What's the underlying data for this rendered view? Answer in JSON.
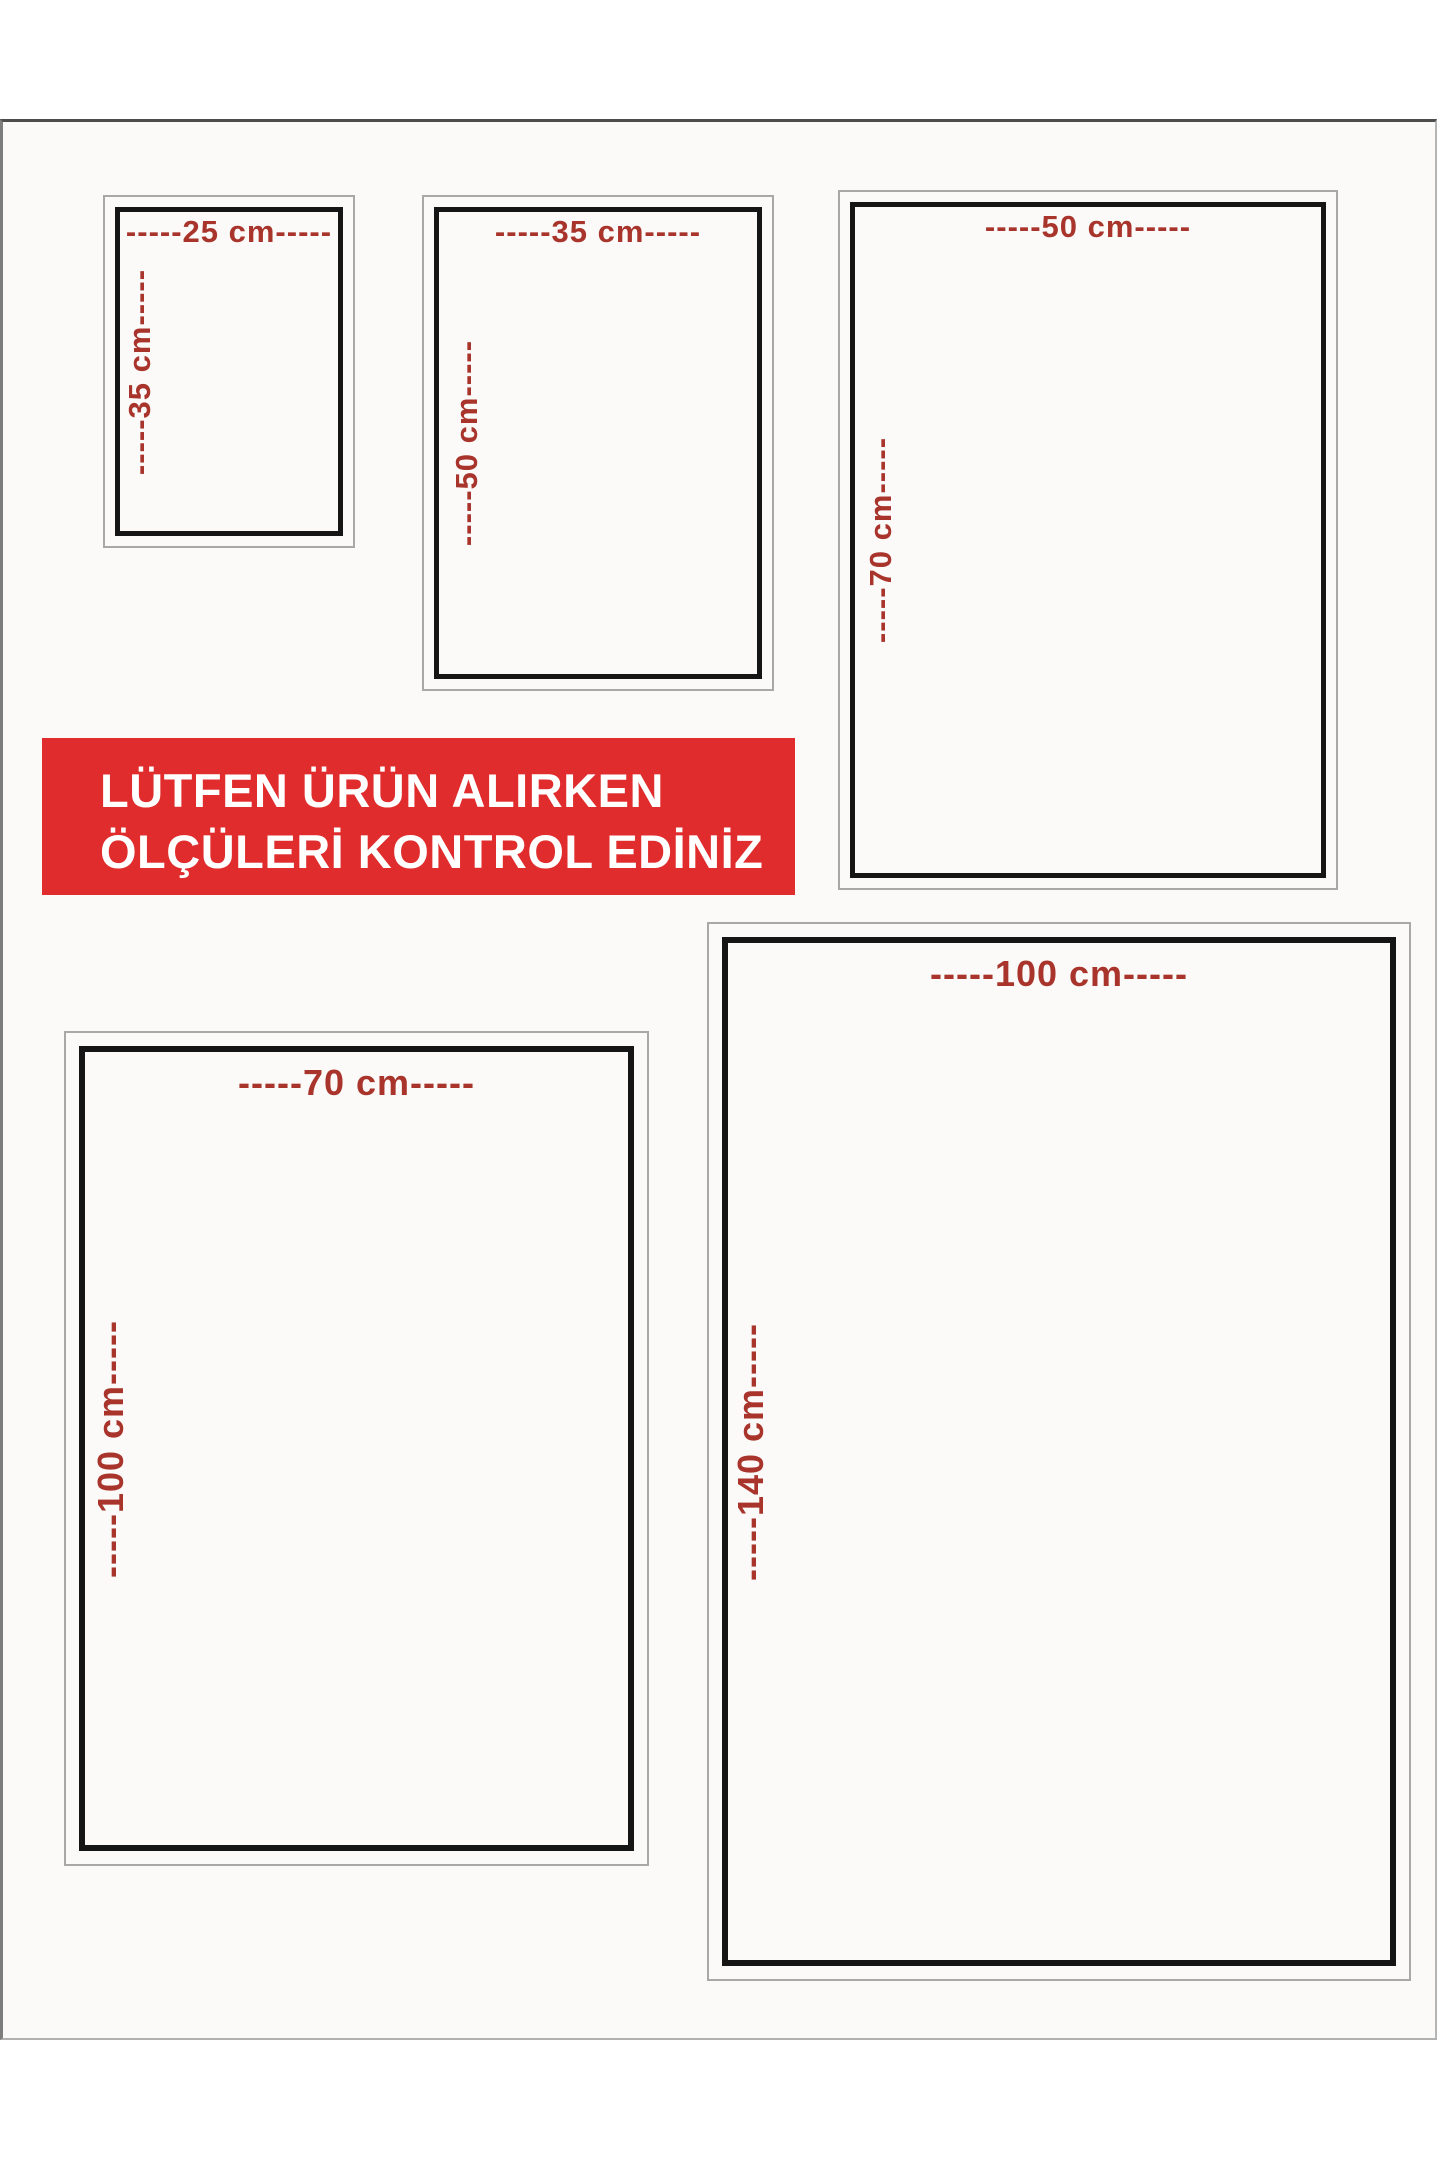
{
  "banner": {
    "line1": "LÜTFEN ÜRÜN ALIRKEN",
    "line2": "ÖLÇÜLERİ KONTROL EDİNİZ",
    "background_color": "#e02c2c",
    "text_color": "#ffffff"
  },
  "colors": {
    "dimension_text": "#a8342c",
    "frame_black": "#151515",
    "frame_gray": "#a8a8a8",
    "sheet_background": "#fbfaf8"
  },
  "unit": "cm",
  "sizes": [
    {
      "name": "25x35",
      "width_cm": 25,
      "height_cm": 35,
      "width_label": "-----25 cm-----",
      "height_label": "-----35 cm-----"
    },
    {
      "name": "35x50",
      "width_cm": 35,
      "height_cm": 50,
      "width_label": "-----35 cm-----",
      "height_label": "-----50 cm-----"
    },
    {
      "name": "50x70",
      "width_cm": 50,
      "height_cm": 70,
      "width_label": "-----50 cm-----",
      "height_label": "-----70 cm-----"
    },
    {
      "name": "70x100",
      "width_cm": 70,
      "height_cm": 100,
      "width_label": "-----70 cm-----",
      "height_label": "-----100 cm-----"
    },
    {
      "name": "100x140",
      "width_cm": 100,
      "height_cm": 140,
      "width_label": "-----100 cm-----",
      "height_label": "-----140 cm-----"
    }
  ]
}
